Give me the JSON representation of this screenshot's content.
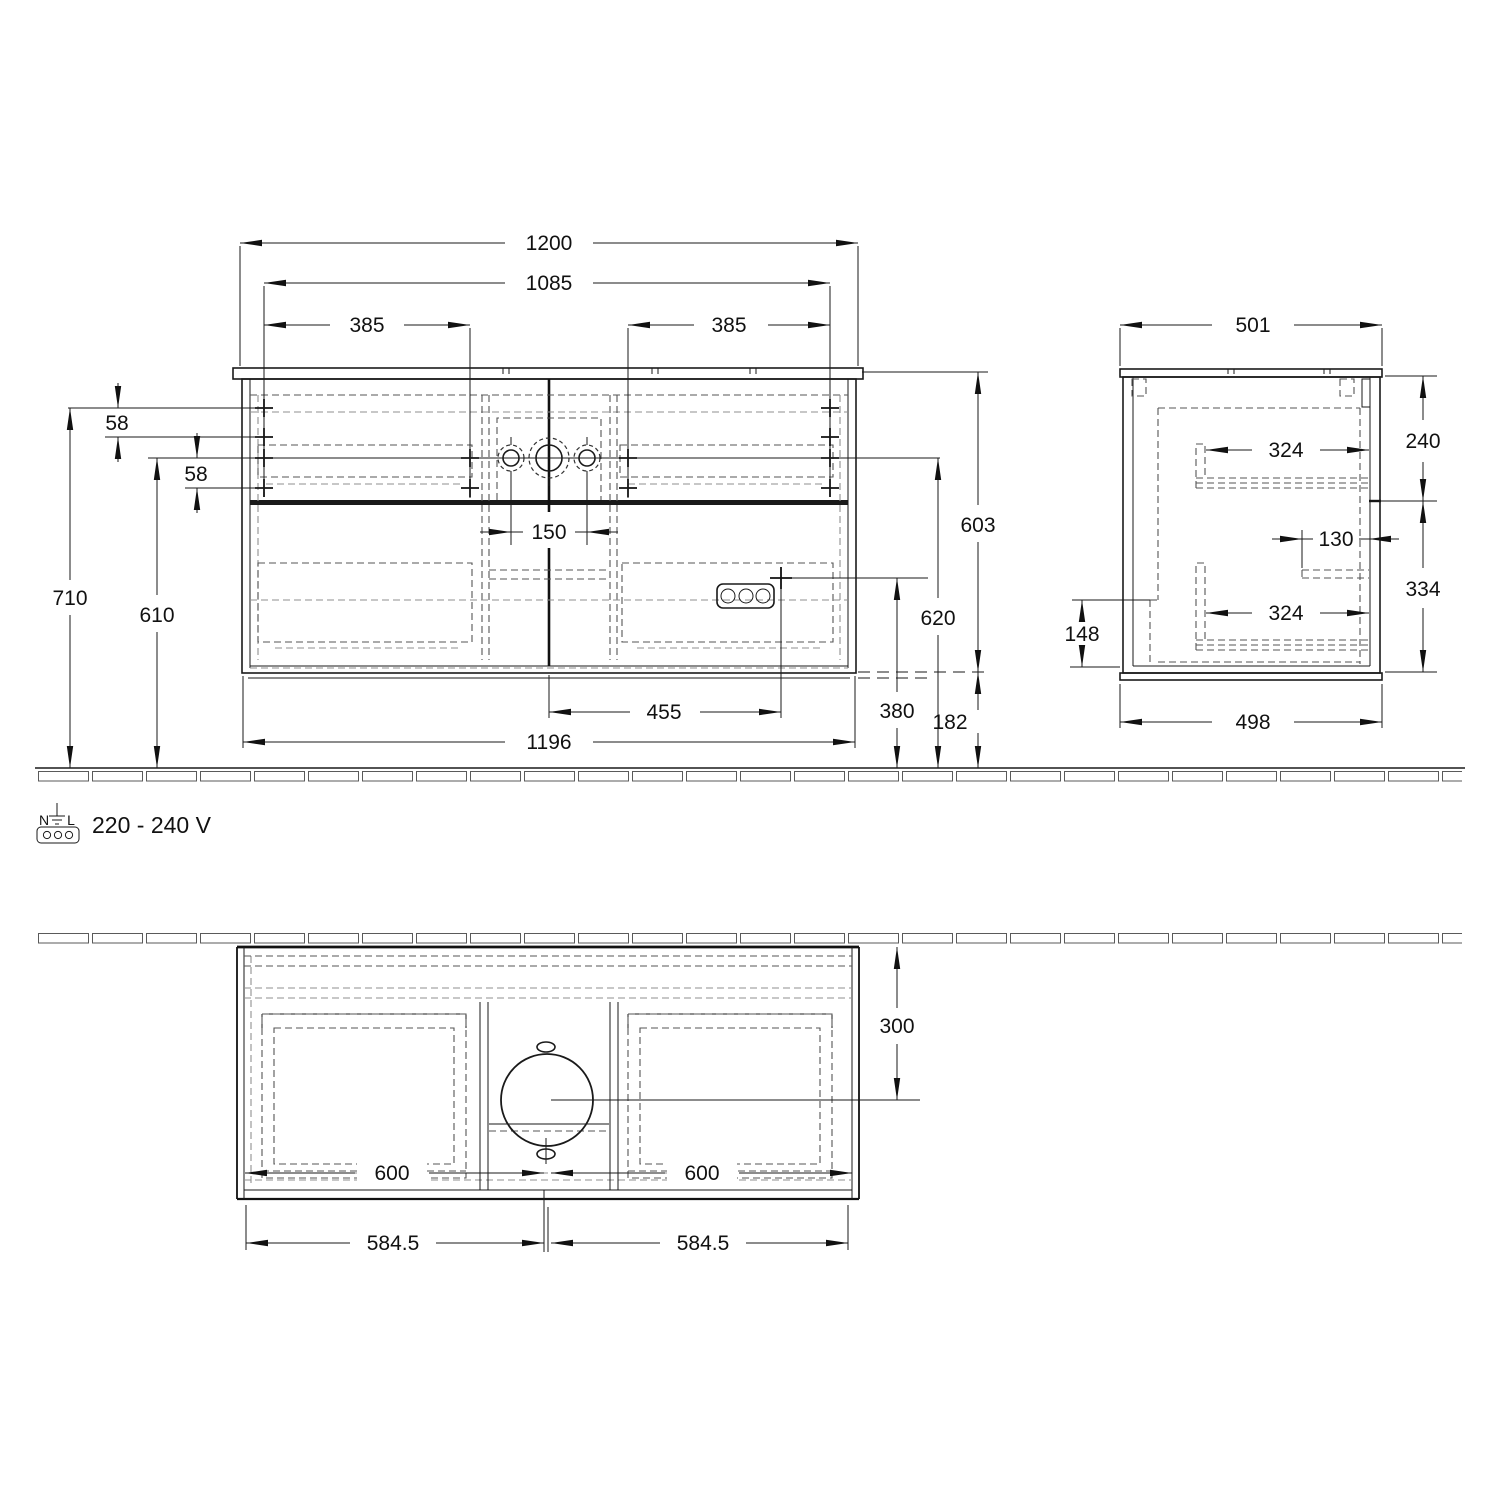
{
  "drawing": {
    "type": "furniture-installation-drawing",
    "colors": {
      "line": "#1a1a1a",
      "hidden_line": "#8f8f8f",
      "background": "#ffffff"
    }
  },
  "front_view": {
    "overall_width": "1200",
    "mounting_span": "1085",
    "mounting_left": "385",
    "mounting_right": "385",
    "offset_row1": "58",
    "offset_row2": "58",
    "height_to_top_row": "710",
    "height_to_tap_row": "610",
    "tap_hole_spacing": "150",
    "cabinet_height": "603",
    "outlet_height": "620",
    "outlet_drop": "380",
    "under_clearance": "182",
    "outlet_offset": "455",
    "cabinet_width": "1196"
  },
  "side_view": {
    "depth_top": "501",
    "upper_drawer_height": "240",
    "upper_rail_depth": "324",
    "rail_offset": "130",
    "lower_drawer_height": "334",
    "back_cutout_height": "148",
    "lower_rail_depth": "324",
    "depth_bottom": "498"
  },
  "plan_view": {
    "basin_center_depth": "300",
    "drawer_width_left": "600",
    "drawer_width_right": "600",
    "half_width_left": "584.5",
    "half_width_right": "584.5"
  },
  "power": {
    "neutral": "N",
    "line": "L",
    "voltage": "220 - 240 V"
  }
}
